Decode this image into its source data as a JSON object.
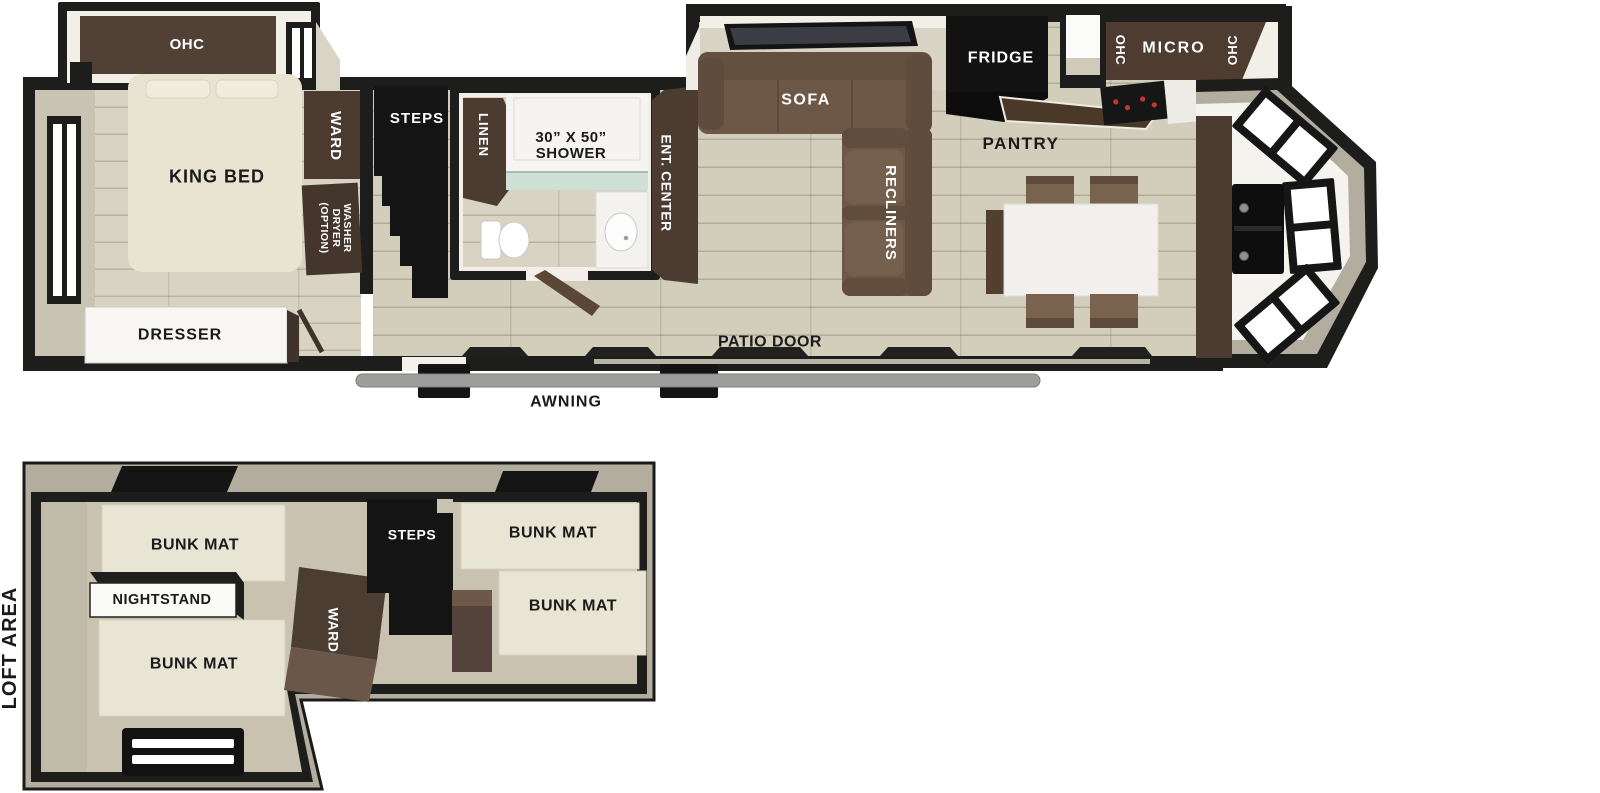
{
  "main_floorplan": {
    "bedroom": {
      "ohc": "OHC",
      "king_bed": "KING BED",
      "ward": "WARD",
      "washer_line1": "WASHER",
      "washer_line2": "DRYER",
      "washer_line3": "(OPTION)",
      "dresser": "DRESSER"
    },
    "bathroom": {
      "steps": "STEPS",
      "linen": "LINEN",
      "shower_size": "30” X 50”",
      "shower": "SHOWER"
    },
    "living": {
      "ent_center": "ENT. CENTER",
      "sofa": "SOFA",
      "recliners": "RECLINERS"
    },
    "kitchen": {
      "fridge": "FRIDGE",
      "pantry": "PANTRY",
      "ohc_left": "OHC",
      "micro": "MICRO",
      "ohc_right": "OHC"
    },
    "exterior": {
      "patio_door": "PATIO DOOR",
      "awning": "AWNING"
    }
  },
  "loft_floorplan": {
    "title": "LOFT AREA",
    "bunk_top_left": "BUNK MAT",
    "nightstand": "NIGHTSTAND",
    "bunk_bottom_left": "BUNK MAT",
    "ward": "WARD",
    "steps": "STEPS",
    "bunk_top_right": "BUNK MAT",
    "bunk_bottom_right": "BUNK MAT"
  },
  "colors": {
    "wall": "#1d1d1b",
    "cabinet_brown": "#4c3b31",
    "sofa_brown": "#6d5746",
    "bed_cream": "#e9e4d1",
    "floor_main": "#d3cdbb",
    "floor_bedroom": "#d8d3c3",
    "loft_wall_gray": "#b3ada0",
    "curtain_teal": "#cfe1d7",
    "awning_gray": "#9e9e9c",
    "label_light": "#ffffff",
    "label_dark": "#1a1a1a",
    "appliance_black": "#141414"
  }
}
